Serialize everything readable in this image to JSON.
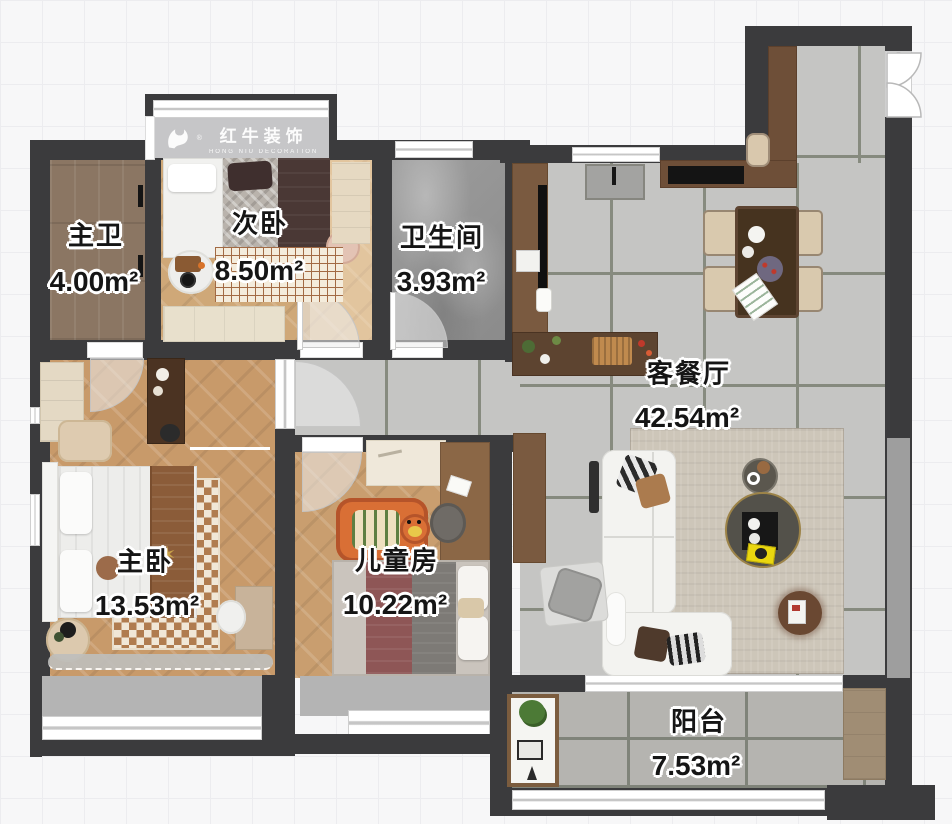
{
  "brand": {
    "name": "红牛装饰",
    "reg": "®",
    "subtitle": "HONG NIU DECORATION"
  },
  "rooms": [
    {
      "id": "master_bath",
      "name": "主卫",
      "area": "4.00m²"
    },
    {
      "id": "second_bedroom",
      "name": "次卧",
      "area": "8.50m²"
    },
    {
      "id": "bathroom",
      "name": "卫生间",
      "area": "3.93m²"
    },
    {
      "id": "living_dining",
      "name": "客餐厅",
      "area": "42.54m²"
    },
    {
      "id": "master_bedroom",
      "name": "主卧",
      "area": "13.53m²"
    },
    {
      "id": "kids_room",
      "name": "儿童房",
      "area": "10.22m²"
    },
    {
      "id": "balcony",
      "name": "阳台",
      "area": "7.53m²"
    }
  ],
  "colors": {
    "wall": "#3b3b3d",
    "tile_floor": "#c5c5c3",
    "balcony_floor": "#b5b4b0",
    "wood_floor": "#c89a6a",
    "dark_wood_floor": "#8b7663",
    "marble_floor": "#9a9a9a",
    "counter_brown": "#6e4f38",
    "sofa_white": "#f3f3f0",
    "label_text": "#151515",
    "label_outline": "#ffffff",
    "accent_yellow": "#ead70f"
  }
}
